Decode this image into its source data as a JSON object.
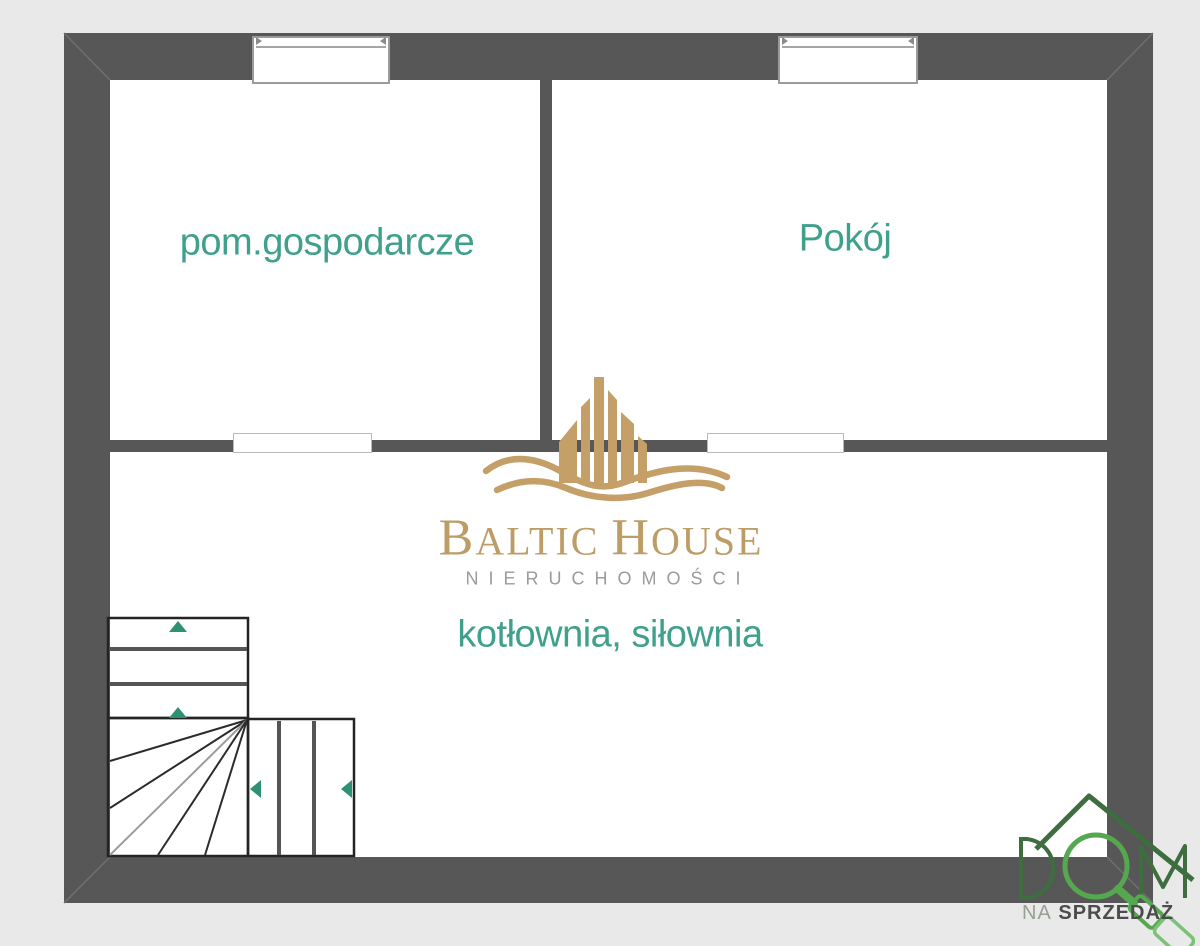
{
  "plan": {
    "room_labels": {
      "utility": "pom.gospodarcze",
      "bedroom": "Pokój",
      "boiler": "kotłownia, siłownia"
    },
    "colors": {
      "wall": "#575757",
      "room_label": "#3fa08b",
      "stair_arrow": "#2f9173"
    }
  },
  "watermark": {
    "brand_initial_1": "B",
    "brand_part_1": "ALTIC ",
    "brand_initial_2": "H",
    "brand_part_2": "OUSE",
    "subtitle": "NIERUCHOMOŚCI",
    "color_gold": "#c49f68"
  },
  "agency": {
    "letter_d": "D",
    "letter_m": "M",
    "tagline_prefix": "NA",
    "tagline_main": " SPRZEDAŻ",
    "color_green_dark": "#3e6d3f",
    "color_green_bright": "#55a84f"
  }
}
